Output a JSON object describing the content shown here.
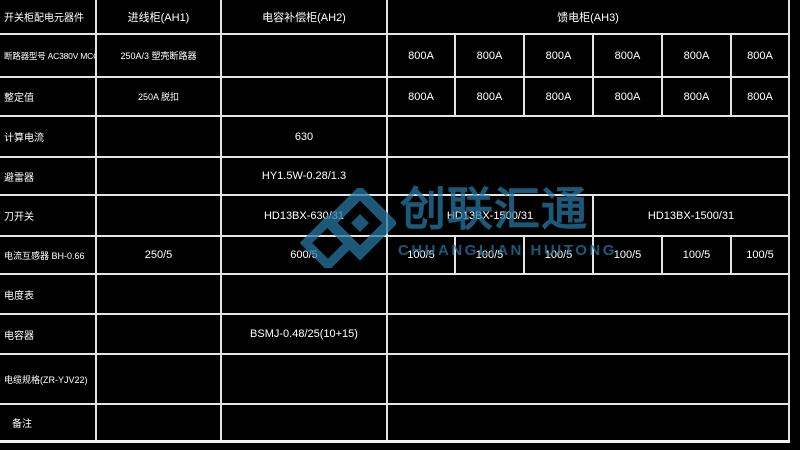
{
  "watermark": {
    "brand_cn": "创联汇通",
    "brand_en": "CHUANGLIAN HUITONG",
    "color": "#2778a4",
    "logo": "double-diamond-logo"
  },
  "table": {
    "line_color": "#e4e4e4",
    "background": "#000000",
    "rows": [
      {
        "cells": [
          "开关柜配电元器件",
          "进线柜(AH1)",
          "电容补偿柜(AH2)",
          "馈电柜(AH3)"
        ]
      },
      {
        "cells": [
          "断路器型号 AC380V MCCB",
          "250A/3 塑壳断路器",
          "",
          "800A",
          "800A",
          "800A",
          "800A",
          "800A",
          "800A"
        ]
      },
      {
        "cells": [
          "整定值",
          "250A 脱扣",
          "",
          "800A",
          "800A",
          "800A",
          "800A",
          "800A",
          "800A"
        ]
      },
      {
        "cells": [
          "计算电流",
          "",
          "630",
          ""
        ]
      },
      {
        "cells": [
          "避雷器",
          "",
          "HY1.5W-0.28/1.3",
          ""
        ]
      },
      {
        "cells": [
          "刀开关",
          "",
          "HD13BX-630/31",
          "HD13BX-1500/31",
          "HD13BX-1500/31"
        ]
      },
      {
        "cells": [
          "电流互感器 BH-0.66",
          "250/5",
          "600/5",
          "100/5",
          "100/5",
          "100/5",
          "100/5",
          "100/5",
          "100/5"
        ]
      },
      {
        "cells": [
          "电度表",
          "",
          "",
          ""
        ]
      },
      {
        "cells": [
          "电容器",
          "",
          "BSMJ-0.48/25(10+15)",
          ""
        ]
      },
      {
        "cells": [
          "电缆规格(ZR-YJV22)",
          "",
          "",
          ""
        ]
      },
      {
        "cells": [
          "备注",
          "",
          "",
          ""
        ]
      }
    ]
  }
}
